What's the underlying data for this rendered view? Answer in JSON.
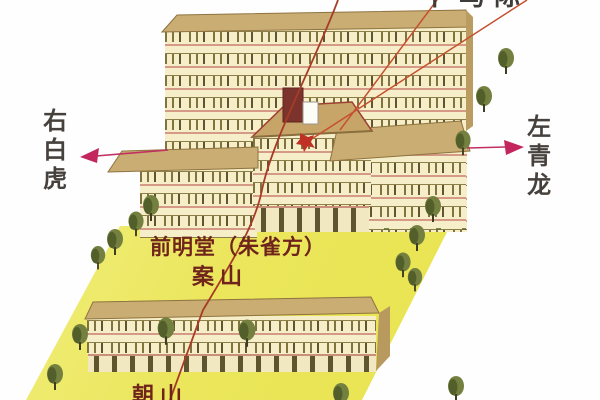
{
  "diagram": {
    "labels": {
      "top_partial": "卜马际",
      "right_white_tiger": "右白虎",
      "left_azure_dragon": "左青龙",
      "front_hall": "前明堂（朱雀方）",
      "case_mountain": "案山",
      "facing_mountain": "朝山"
    },
    "colors": {
      "courtyard_yellow": "#ebe65c",
      "facade_cream": "#f6eec8",
      "roof_tan": "#c9ad72",
      "tree_olive": "#73803f",
      "axis_red": "#a63b28",
      "leader_red": "#c4502f",
      "arrow_magenta": "#c2265c",
      "label_dark": "#46413d",
      "label_maroon": "#6f241b",
      "chimney_maroon": "#7b332c"
    }
  }
}
